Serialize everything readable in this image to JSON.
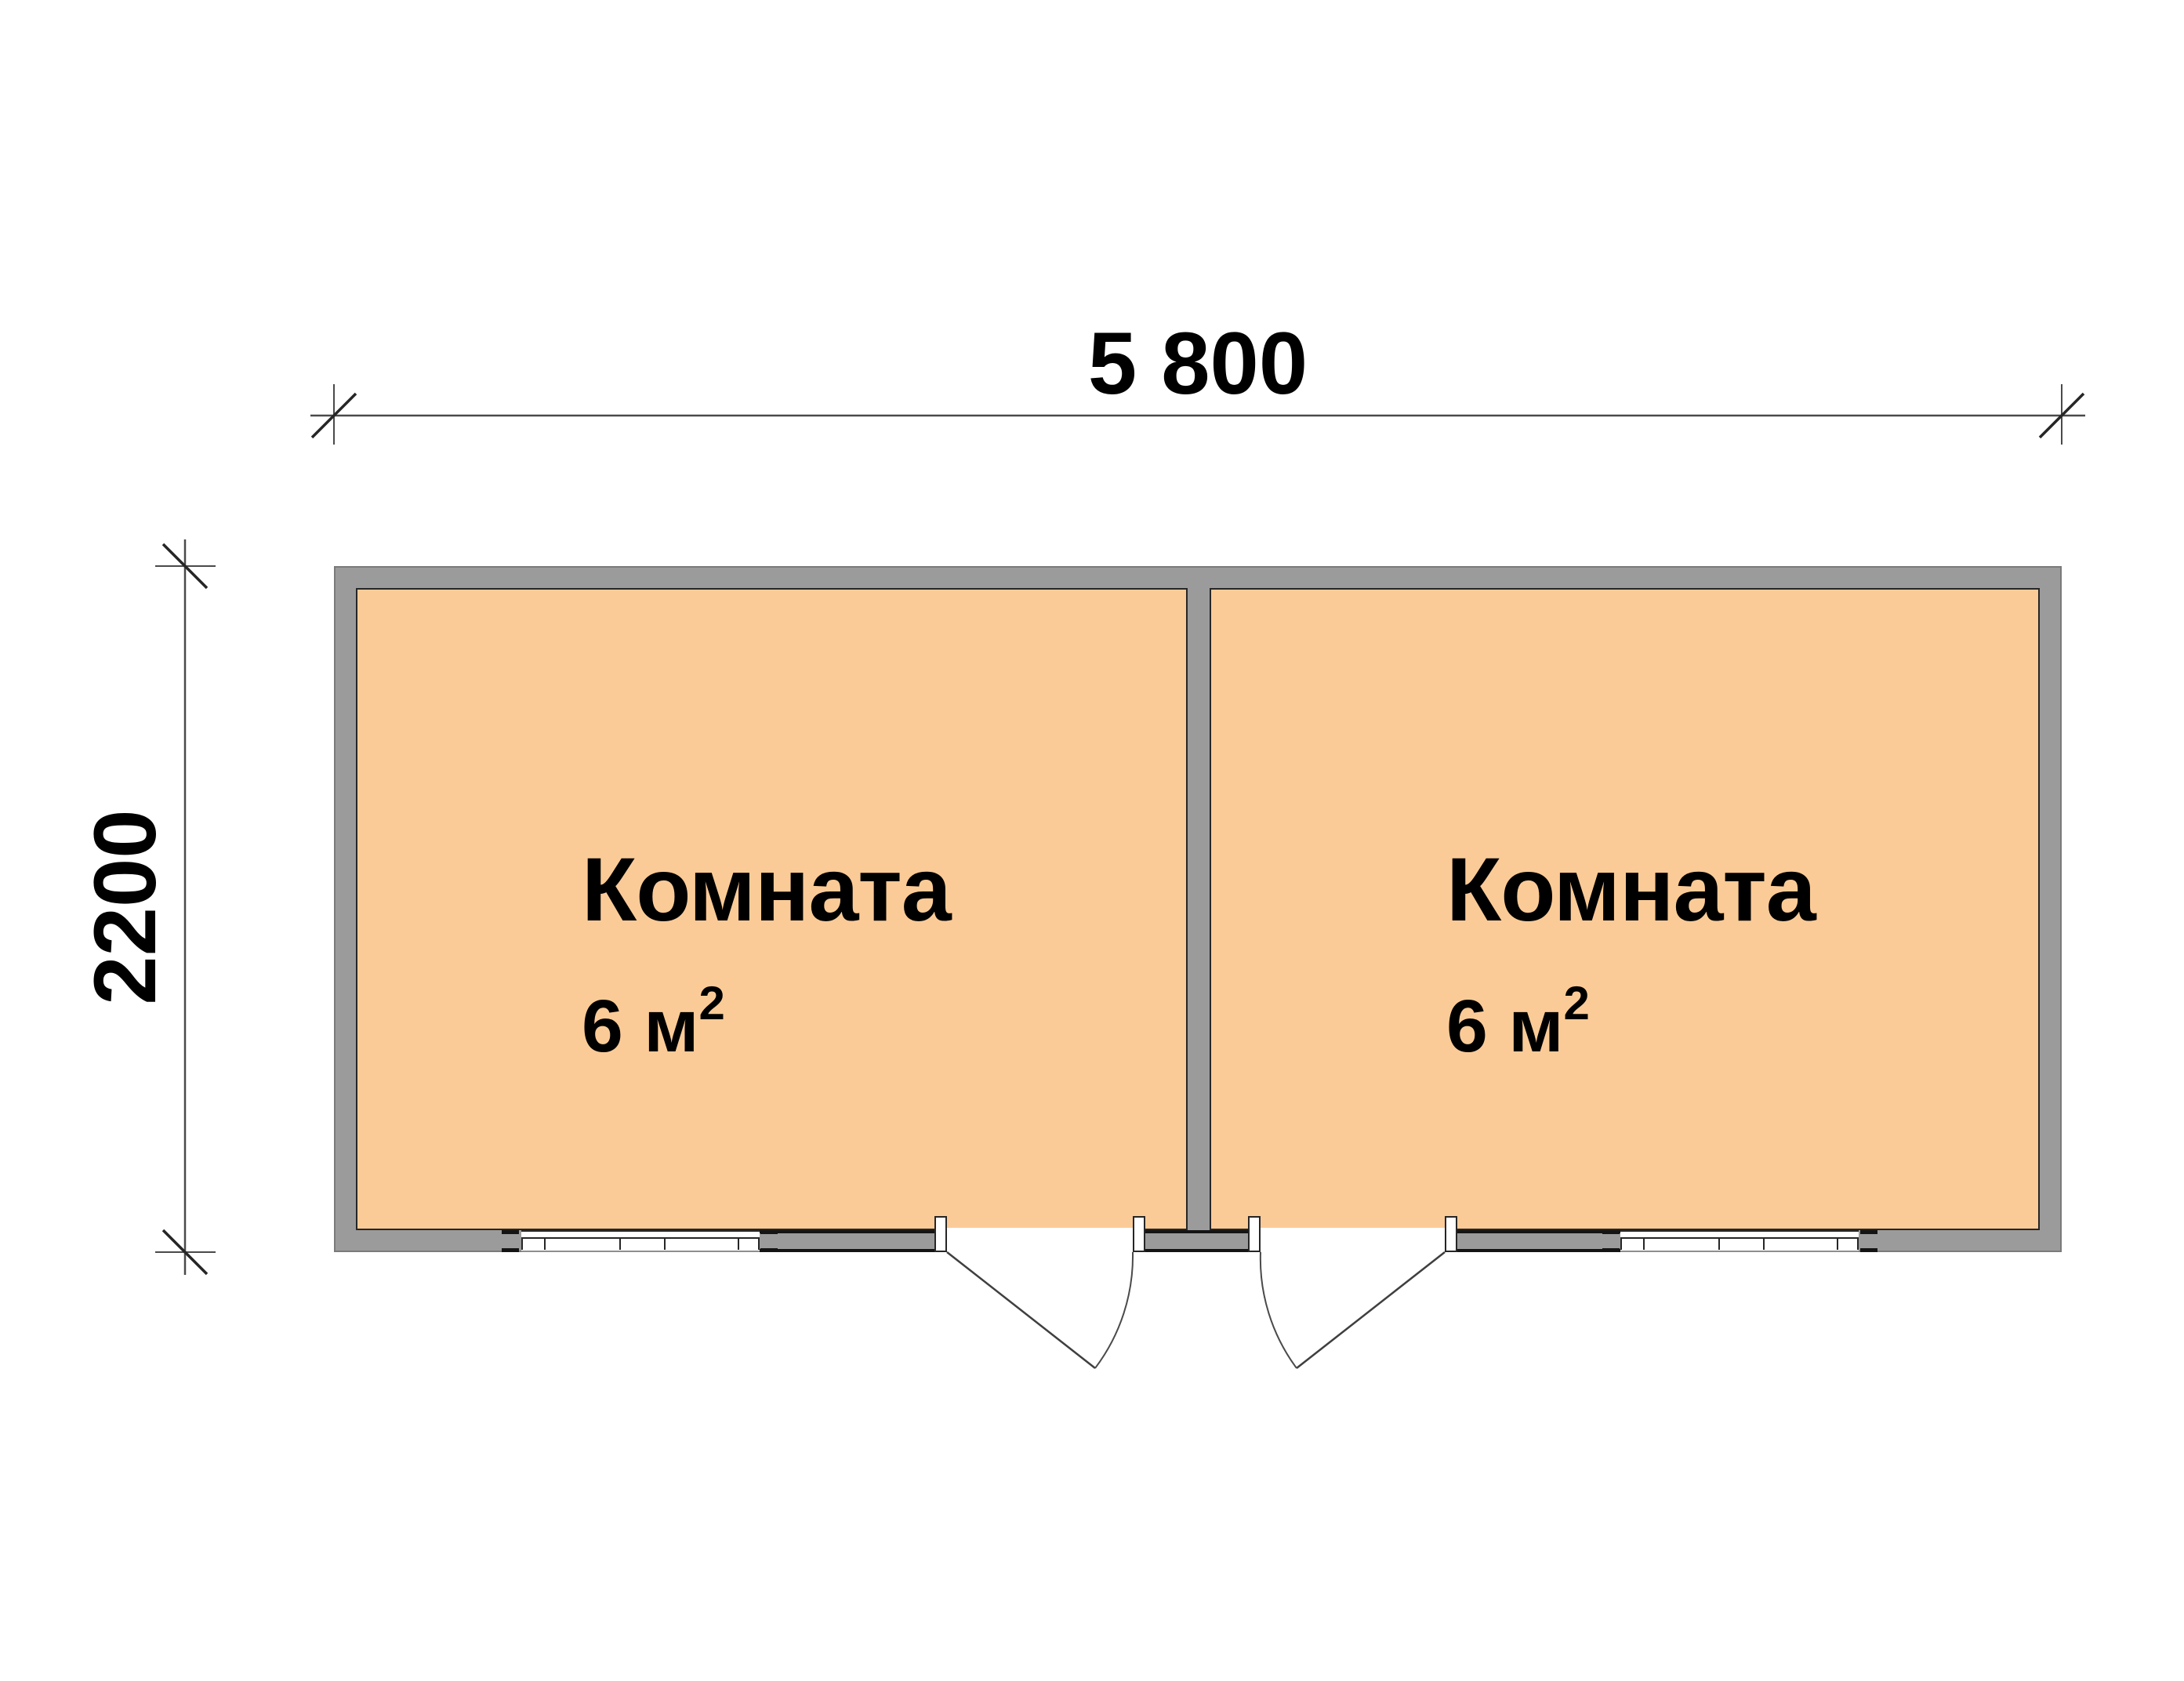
{
  "dimensions": {
    "width_label": "5 800",
    "height_label": "2200"
  },
  "rooms": [
    {
      "name": "Комната",
      "area_value": "6 м",
      "area_sup": "2"
    },
    {
      "name": "Комната",
      "area_value": "6 м",
      "area_sup": "2"
    }
  ],
  "colors": {
    "background": "#ffffff",
    "room_fill": "#fbcb97",
    "wall_fill": "#9b9b9b",
    "wall_border": "#7a7a7a",
    "outline_dark": "#262626",
    "opening_caps": "#141414",
    "dimension_line": "#4a4a4a",
    "text": "#000000"
  }
}
